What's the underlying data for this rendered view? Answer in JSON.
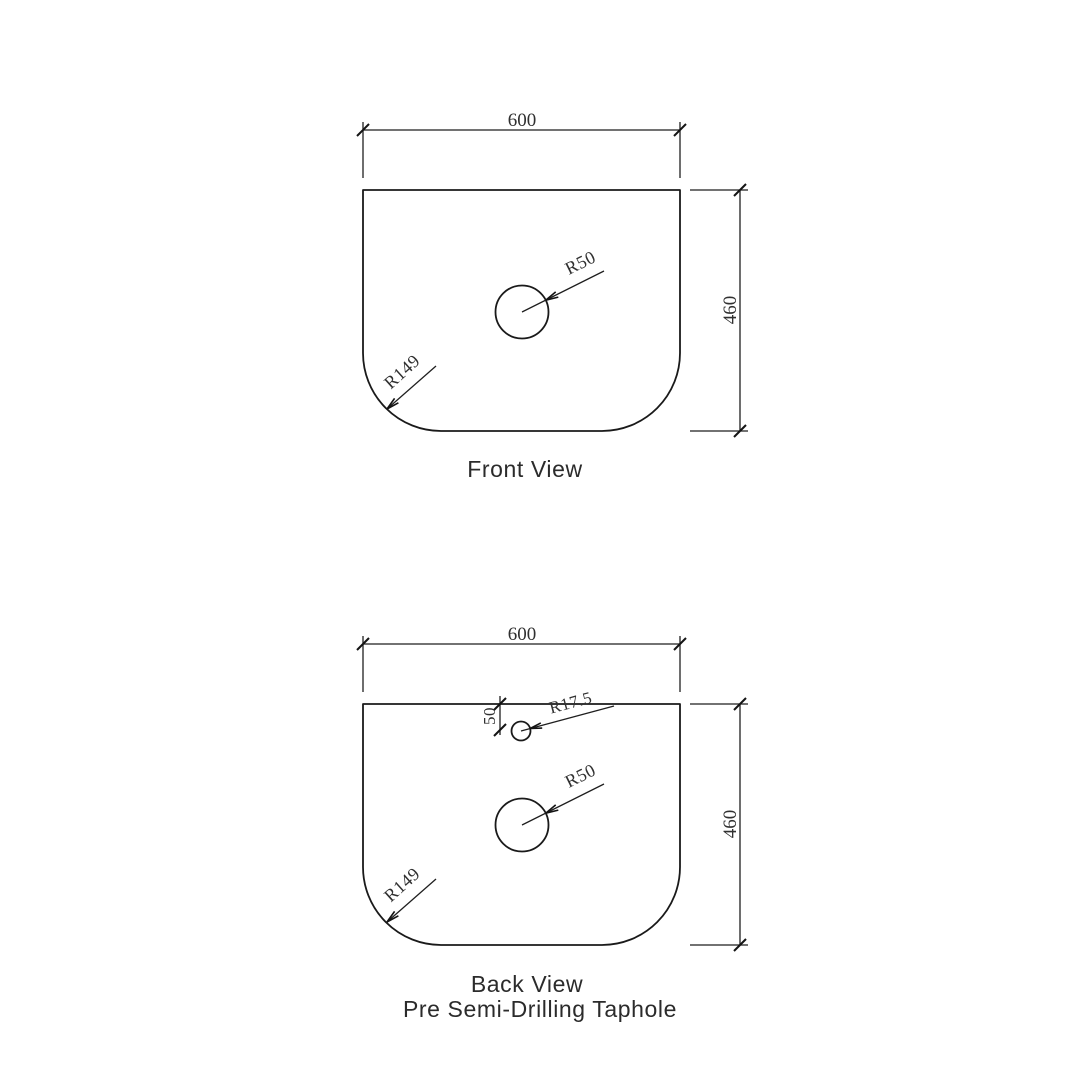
{
  "page": {
    "background_color": "#ffffff",
    "line_color": "#1a1a1a",
    "text_color": "#303030"
  },
  "front_view": {
    "title": "Front View",
    "dimensions": {
      "width": "600",
      "height": "460"
    },
    "annotations": {
      "hole_radius": "R50",
      "corner_radius": "R149"
    }
  },
  "back_view": {
    "title": "Back View",
    "subtitle": "Pre Semi-Drilling Taphole",
    "dimensions": {
      "width": "600",
      "height": "460",
      "taphole_offset": "50"
    },
    "annotations": {
      "hole_radius": "R50",
      "corner_radius": "R149",
      "taphole_radius": "R17.5"
    }
  }
}
